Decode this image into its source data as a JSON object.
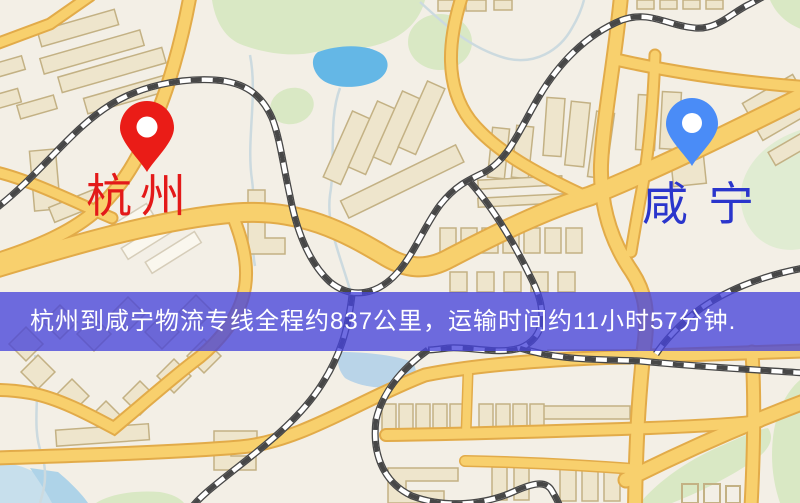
{
  "banner": {
    "text": "杭州到咸宁物流专线全程约837公里，运输时间约11小时57分钟.",
    "background_color": "rgba(70,68,218,0.78)",
    "text_color": "#ffffff"
  },
  "map": {
    "origin": {
      "name": "杭州",
      "label_color": "#e31919",
      "pin_color": "#ea1c17"
    },
    "destination": {
      "name": "咸宁",
      "label_color": "#2a35cc",
      "pin_color": "#4a8cf7"
    },
    "palette": {
      "background": "#f3efe6",
      "road_fill": "#f8d06d",
      "road_casing": "#e2ab49",
      "building_fill": "#eee5cc",
      "building_stroke": "#c3b184",
      "green_area": "#d9e8c4",
      "pond_water": "#64b7e6",
      "shore_water": "#b9d4e8",
      "railway": "#474747"
    }
  }
}
